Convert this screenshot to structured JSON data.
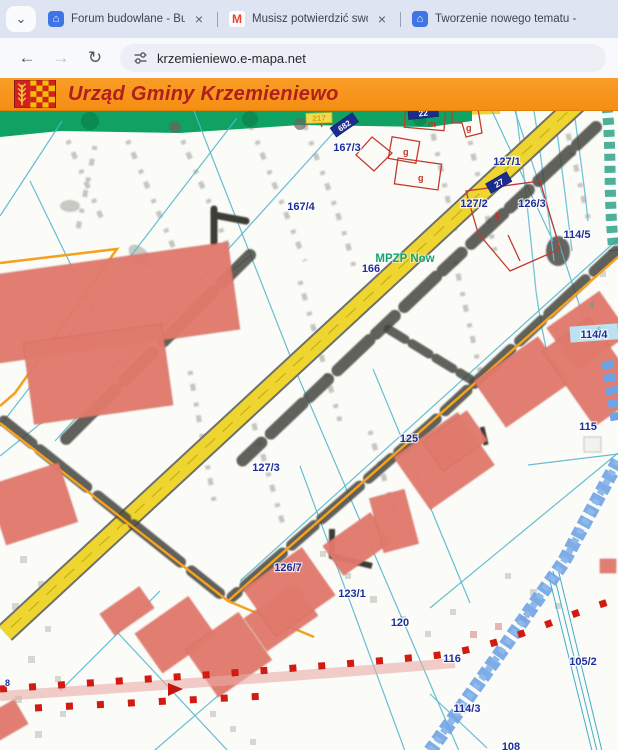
{
  "browser": {
    "icons": {
      "tab_search": "⌄",
      "close": "×",
      "home": "⌂",
      "gmail": "M",
      "back": "←",
      "forward": "→",
      "reload": "↻"
    },
    "tabs": [
      {
        "label": "Forum budowlane - Budujemy Dom"
      },
      {
        "label": "Musisz potwierdzić swoje konto"
      },
      {
        "label": "Tworzenie nowego tematu - "
      }
    ],
    "toolbar": {
      "url": "krzemieniewo.e-mapa.net"
    }
  },
  "banner": {
    "title": "Urząd Gminy Krzemieniewo"
  },
  "map": {
    "plan_label": "MPZP Now",
    "road_label": "217",
    "plates": {
      "p22": "22",
      "p682": "682",
      "p27": "27"
    },
    "building_letters": {
      "m": "m",
      "g1": "g",
      "g2": "g",
      "g3": "g",
      "k": "k"
    },
    "utility_letters": {
      "s1": "s",
      "s2": "s"
    },
    "parcels": {
      "p167_3": "167/3",
      "p167_4": "167/4",
      "p166": "166",
      "p127_1": "127/1",
      "p127_2": "127/2",
      "p126_3": "126/3",
      "p114_5": "114/5",
      "p114_4": "114/4",
      "p115": "115",
      "p125": "125",
      "p127_3": "127/3",
      "p126_7": "126/7",
      "p123_1": "123/1",
      "p120": "120",
      "p116": "116",
      "p105_2": "105/2",
      "p114_3": "114/3",
      "p108": "108",
      "p8": "8"
    },
    "colors": {
      "banner": "#F7941E",
      "title": "#B01E1E",
      "road": "#EFD52F",
      "parcel_line": "#58B7CC",
      "label": "#1E2F9C",
      "highlight": "#F5A11D",
      "building": "#E07A6C",
      "stream": "#6FA3E3",
      "plan_text": "#12A36E",
      "green_strip": "#0FA263",
      "red_dots": "#D11B12"
    }
  }
}
